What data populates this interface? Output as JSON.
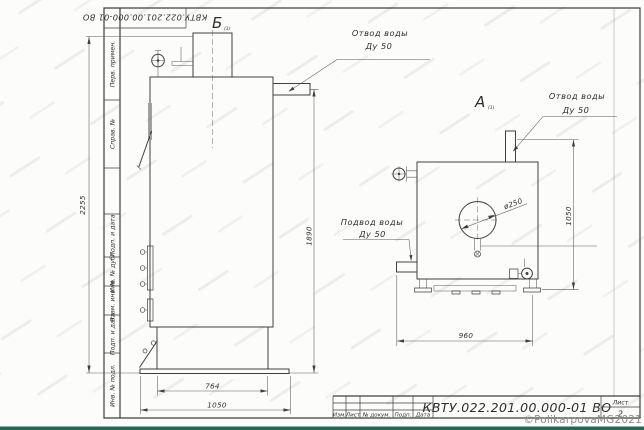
{
  "document": {
    "top_rotated_number": "КВТУ.022.201.00.000-01 ВО",
    "doc_number": "КВТУ.022.201.00.000-01 ВО",
    "sheet_label": "Лист",
    "sheet_number": "2",
    "revision_columns": [
      "Изм.",
      "Лист",
      "№ докум.",
      "Подп.",
      "Дата"
    ],
    "margin_fields": [
      "Перв. примен.",
      "Справ. №",
      "Подп. и дата",
      "Инв. № дубл.",
      "Взам. инв. №",
      "Подп. и дата",
      "Инв. № подл."
    ]
  },
  "views": {
    "left": {
      "label": "Б",
      "label_note": "(1)",
      "callouts": {
        "outlet_line1": "Отвод воды",
        "outlet_line2": "Ду 50"
      },
      "dims": {
        "height_total": "2255",
        "height_outlet": "1890",
        "width_inner": "764",
        "width_total": "1050"
      }
    },
    "right": {
      "label": "А",
      "label_note": "(1)",
      "callouts": {
        "outlet_line1": "Отвод воды",
        "outlet_line2": "Ду 50",
        "inlet_line1": "Подвод воды",
        "inlet_line2": "Ду 50"
      },
      "dims": {
        "height": "1050",
        "width": "960",
        "door_dia": "ø250"
      }
    }
  },
  "watermark": {
    "text": "©PolikarpovaMG2021"
  },
  "colors": {
    "line": "#3f3f3f",
    "thin_line": "#5a5a5a",
    "paper": "#fcfcfb",
    "accent_bar": "#1d6a55",
    "watermark_text": "#8d8d8d"
  }
}
